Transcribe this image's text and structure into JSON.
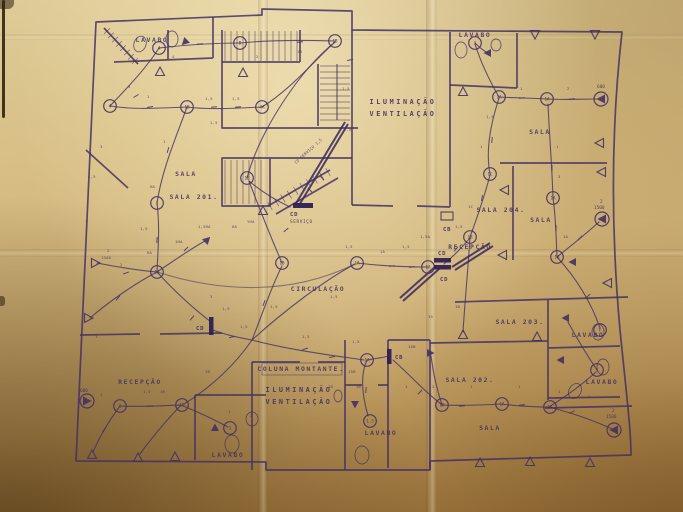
{
  "photo": {
    "paper_color": "#cfb278",
    "ink_color": "#453064",
    "ink_bold": "#2e2052"
  },
  "titles": {
    "shaft_top": {
      "lines": [
        "ILUMINAÇÃO",
        "VENTILAÇÃO"
      ],
      "x": 403,
      "y": 104
    },
    "shaft_bottom": {
      "lines": [
        "ILUMINAÇÃO",
        "VENTILAÇÃO"
      ],
      "x": 299,
      "y": 392
    }
  },
  "rooms": [
    {
      "label": "LAVABO",
      "x": 152,
      "y": 42
    },
    {
      "label": "LAVABO",
      "x": 475,
      "y": 37
    },
    {
      "label": "SALA",
      "x": 540,
      "y": 134
    },
    {
      "label": "SALA",
      "x": 186,
      "y": 176
    },
    {
      "label": "SALA 201.",
      "x": 194,
      "y": 199
    },
    {
      "label": "SALA 204.",
      "x": 501,
      "y": 212
    },
    {
      "label": "RECEPÇÃO",
      "x": 470,
      "y": 249
    },
    {
      "label": "SALA",
      "x": 541,
      "y": 222
    },
    {
      "label": "CIRCULAÇÃO",
      "x": 318,
      "y": 291
    },
    {
      "label": "SALA 203.",
      "x": 520,
      "y": 324
    },
    {
      "label": "LAVABO",
      "x": 588,
      "y": 337
    },
    {
      "label": "LAVABO",
      "x": 602,
      "y": 384
    },
    {
      "label": "SALA 202.",
      "x": 470,
      "y": 382
    },
    {
      "label": "RECEPÇÃO",
      "x": 140,
      "y": 384
    },
    {
      "label": "COLUNA MONTANTE.",
      "x": 301,
      "y": 371
    },
    {
      "label": "LAVABO",
      "x": 381,
      "y": 435
    },
    {
      "label": "LAVABO",
      "x": 228,
      "y": 457
    },
    {
      "label": "SALA",
      "x": 490,
      "y": 430
    }
  ],
  "panels": [
    {
      "label": "CD",
      "sub": "SERVIÇO",
      "bar": [
        293,
        203,
        20,
        5
      ],
      "lx": 290,
      "ly": 216,
      "sx": 290,
      "sy": 223
    },
    {
      "label": "CD",
      "sub": "",
      "bar": [
        434,
        258,
        17,
        4.5
      ],
      "lx": 438,
      "ly": 255,
      "sx": 0,
      "sy": 0
    },
    {
      "label": "CD",
      "sub": "",
      "bar": [
        434,
        265,
        17,
        4.5
      ],
      "lx": 440,
      "ly": 281,
      "sx": 0,
      "sy": 0
    },
    {
      "label": "CD",
      "sub": "",
      "bar": [
        209,
        317,
        4.5,
        18
      ],
      "lx": 196,
      "ly": 330,
      "sx": 0,
      "sy": 0
    },
    {
      "label": "CB",
      "sub": "",
      "bar": [
        387,
        349,
        4.5,
        15
      ],
      "lx": 395,
      "ly": 359,
      "sx": 0,
      "sy": 0
    },
    {
      "label": "CB",
      "sub": "",
      "box": [
        441,
        212,
        12,
        8
      ],
      "lx": 443,
      "ly": 231,
      "sx": 0,
      "sy": 0
    }
  ],
  "lights": [
    {
      "x": 159,
      "y": 48,
      "t": "4"
    },
    {
      "x": 240,
      "y": 43,
      "t": "B"
    },
    {
      "x": 335,
      "y": 41,
      "t": "1B"
    },
    {
      "x": 110,
      "y": 106,
      "t": "4"
    },
    {
      "x": 187,
      "y": 107,
      "t": "1B"
    },
    {
      "x": 262,
      "y": 107,
      "t": "4A"
    },
    {
      "x": 247,
      "y": 178,
      "t": "1B"
    },
    {
      "x": 157,
      "y": 203,
      "t": "1"
    },
    {
      "x": 157,
      "y": 272,
      "t": "1A"
    },
    {
      "x": 282,
      "y": 263,
      "t": "1B"
    },
    {
      "x": 357,
      "y": 263,
      "t": "1A"
    },
    {
      "x": 428,
      "y": 267,
      "t": "1A"
    },
    {
      "x": 470,
      "y": 237,
      "t": "1B"
    },
    {
      "x": 490,
      "y": 174,
      "t": "1C"
    },
    {
      "x": 499,
      "y": 97,
      "t": "1A"
    },
    {
      "x": 547,
      "y": 99,
      "t": "1A"
    },
    {
      "x": 475,
      "y": 43,
      "t": "1"
    },
    {
      "x": 553,
      "y": 198,
      "t": "1A"
    },
    {
      "x": 557,
      "y": 257,
      "t": "1A"
    },
    {
      "x": 367,
      "y": 360,
      "t": "1A"
    },
    {
      "x": 370,
      "y": 421,
      "t": "1,5"
    },
    {
      "x": 120,
      "y": 406,
      "t": "1"
    },
    {
      "x": 182,
      "y": 405,
      "t": "1B"
    },
    {
      "x": 230,
      "y": 428,
      "t": "1"
    },
    {
      "x": 442,
      "y": 405,
      "t": "1B"
    },
    {
      "x": 502,
      "y": 404,
      "t": "1A"
    },
    {
      "x": 550,
      "y": 407,
      "t": "1A"
    },
    {
      "x": 597,
      "y": 370,
      "t": "1"
    },
    {
      "x": 600,
      "y": 330,
      "t": "F"
    }
  ],
  "fans": [
    {
      "x": 601,
      "y": 99,
      "r": 180,
      "label": "600",
      "lx": 597,
      "ly": 88
    },
    {
      "x": 602,
      "y": 219,
      "r": 180,
      "label": "2",
      "lx": 600,
      "ly": 203,
      "label2": "1500",
      "l2x": 594,
      "l2y": 209
    },
    {
      "x": 614,
      "y": 430,
      "r": 180,
      "label": "2",
      "lx": 612,
      "ly": 412,
      "label2": "1500",
      "l2x": 606,
      "l2y": 418
    },
    {
      "x": 87,
      "y": 401,
      "r": 0,
      "label": "600",
      "lx": 80,
      "ly": 392
    }
  ],
  "vents": [
    {
      "x": 160,
      "y": 72,
      "r": 0
    },
    {
      "x": 243,
      "y": 73,
      "r": 0
    },
    {
      "x": 263,
      "y": 211,
      "r": 0
    },
    {
      "x": 535,
      "y": 34,
      "r": 180
    },
    {
      "x": 595,
      "y": 34,
      "r": 180
    },
    {
      "x": 463,
      "y": 92,
      "r": 0
    },
    {
      "x": 95,
      "y": 263,
      "r": 90
    },
    {
      "x": 88,
      "y": 318,
      "r": 90
    },
    {
      "x": 92,
      "y": 455,
      "r": 0
    },
    {
      "x": 138,
      "y": 458,
      "r": 0
    },
    {
      "x": 175,
      "y": 457,
      "r": 0
    },
    {
      "x": 463,
      "y": 335,
      "r": 0
    },
    {
      "x": 537,
      "y": 337,
      "r": 0
    },
    {
      "x": 480,
      "y": 463,
      "r": 0
    },
    {
      "x": 530,
      "y": 462,
      "r": 0
    },
    {
      "x": 590,
      "y": 463,
      "r": 0
    },
    {
      "x": 608,
      "y": 283,
      "r": 270
    },
    {
      "x": 602,
      "y": 172,
      "r": 270
    },
    {
      "x": 505,
      "y": 190,
      "r": 270
    },
    {
      "x": 503,
      "y": 255,
      "r": 270
    },
    {
      "x": 600,
      "y": 143,
      "r": 270
    }
  ],
  "filled_triangles": [
    {
      "x": 185,
      "y": 42,
      "r": 225
    },
    {
      "x": 207,
      "y": 240,
      "r": 45
    },
    {
      "x": 355,
      "y": 404,
      "r": 180
    },
    {
      "x": 573,
      "y": 262,
      "r": 270
    },
    {
      "x": 215,
      "y": 428,
      "r": 0
    },
    {
      "x": 566,
      "y": 318,
      "r": 270
    },
    {
      "x": 561,
      "y": 360,
      "r": 270
    },
    {
      "x": 488,
      "y": 53,
      "r": 270
    },
    {
      "x": 430,
      "y": 353,
      "r": 90
    }
  ],
  "fixtures": [
    {
      "x": 140,
      "y": 44,
      "rx": 6,
      "ry": 8,
      "r": 20
    },
    {
      "x": 172,
      "y": 39,
      "rx": 6,
      "ry": 8,
      "r": 0
    },
    {
      "x": 461,
      "y": 50,
      "rx": 6,
      "ry": 8,
      "r": 0
    },
    {
      "x": 496,
      "y": 45,
      "rx": 5,
      "ry": 6,
      "r": 0
    },
    {
      "x": 598,
      "y": 332,
      "rx": 6,
      "ry": 8,
      "r": 0
    },
    {
      "x": 603,
      "y": 367,
      "rx": 6,
      "ry": 8,
      "r": 0
    },
    {
      "x": 575,
      "y": 391,
      "rx": 6,
      "ry": 8,
      "r": 30
    },
    {
      "x": 362,
      "y": 455,
      "rx": 7,
      "ry": 9,
      "r": 0
    },
    {
      "x": 338,
      "y": 396,
      "rx": 4,
      "ry": 6,
      "r": 0
    },
    {
      "x": 232,
      "y": 444,
      "rx": 7,
      "ry": 9,
      "r": 0
    },
    {
      "x": 252,
      "y": 419,
      "rx": 6,
      "ry": 7,
      "r": 0
    }
  ],
  "ticks": [
    {
      "x": 136,
      "y": 96,
      "a": 60
    },
    {
      "x": 150,
      "y": 107,
      "a": 80
    },
    {
      "x": 214,
      "y": 107,
      "a": 85
    },
    {
      "x": 238,
      "y": 107,
      "a": 85
    },
    {
      "x": 168,
      "y": 150,
      "a": 15
    },
    {
      "x": 157,
      "y": 240,
      "a": 5
    },
    {
      "x": 126,
      "y": 273,
      "a": 70
    },
    {
      "x": 118,
      "y": 298,
      "a": 40
    },
    {
      "x": 186,
      "y": 249,
      "a": 45
    },
    {
      "x": 192,
      "y": 318,
      "a": 40
    },
    {
      "x": 232,
      "y": 337,
      "a": 75
    },
    {
      "x": 264,
      "y": 303,
      "a": 20
    },
    {
      "x": 305,
      "y": 349,
      "a": 70
    },
    {
      "x": 332,
      "y": 357,
      "a": 80
    },
    {
      "x": 392,
      "y": 266,
      "a": 85
    },
    {
      "x": 412,
      "y": 267,
      "a": 85
    },
    {
      "x": 456,
      "y": 249,
      "a": 40
    },
    {
      "x": 482,
      "y": 198,
      "a": 10
    },
    {
      "x": 492,
      "y": 140,
      "a": 5
    },
    {
      "x": 522,
      "y": 98,
      "a": 85
    },
    {
      "x": 572,
      "y": 99,
      "a": 85
    },
    {
      "x": 552,
      "y": 168,
      "a": 0
    },
    {
      "x": 556,
      "y": 228,
      "a": 0
    },
    {
      "x": 580,
      "y": 238,
      "a": 45
    },
    {
      "x": 588,
      "y": 296,
      "a": 50
    },
    {
      "x": 462,
      "y": 406,
      "a": 85
    },
    {
      "x": 522,
      "y": 405,
      "a": 85
    },
    {
      "x": 572,
      "y": 412,
      "a": 65
    },
    {
      "x": 150,
      "y": 406,
      "a": 85
    },
    {
      "x": 104,
      "y": 430,
      "a": 40
    },
    {
      "x": 366,
      "y": 390,
      "a": 5
    },
    {
      "x": 420,
      "y": 392,
      "a": 45
    },
    {
      "x": 350,
      "y": 60,
      "a": 80
    },
    {
      "x": 300,
      "y": 42,
      "a": 85
    },
    {
      "x": 200,
      "y": 44,
      "a": 85
    },
    {
      "x": 286,
      "y": 230,
      "a": 50
    },
    {
      "x": 310,
      "y": 190,
      "a": -42
    },
    {
      "x": 322,
      "y": 178,
      "a": -42
    }
  ],
  "annotations": [
    {
      "x": 128,
      "y": 88,
      "t": "4"
    },
    {
      "x": 147,
      "y": 98,
      "t": "1"
    },
    {
      "x": 205,
      "y": 100,
      "t": "1,5"
    },
    {
      "x": 232,
      "y": 100,
      "t": "1,5"
    },
    {
      "x": 256,
      "y": 58,
      "t": "2"
    },
    {
      "x": 172,
      "y": 58,
      "t": "4"
    },
    {
      "x": 210,
      "y": 124,
      "t": "1,5"
    },
    {
      "x": 297,
      "y": 53,
      "t": "1B"
    },
    {
      "x": 342,
      "y": 90,
      "t": "1,5"
    },
    {
      "x": 344,
      "y": 131,
      "t": "T.A"
    },
    {
      "x": 163,
      "y": 143,
      "t": "1"
    },
    {
      "x": 150,
      "y": 188,
      "t": "HA"
    },
    {
      "x": 140,
      "y": 230,
      "t": "1,5"
    },
    {
      "x": 147,
      "y": 254,
      "t": "HA"
    },
    {
      "x": 120,
      "y": 266,
      "t": "2"
    },
    {
      "x": 175,
      "y": 243,
      "t": "1HA"
    },
    {
      "x": 198,
      "y": 228,
      "t": "1,5HA"
    },
    {
      "x": 232,
      "y": 228,
      "t": "HA"
    },
    {
      "x": 247,
      "y": 223,
      "t": "YHA"
    },
    {
      "x": 210,
      "y": 298,
      "t": "3"
    },
    {
      "x": 222,
      "y": 310,
      "t": "1,5"
    },
    {
      "x": 240,
      "y": 328,
      "t": "1,5"
    },
    {
      "x": 270,
      "y": 308,
      "t": "1,5"
    },
    {
      "x": 302,
      "y": 338,
      "t": "1,5"
    },
    {
      "x": 330,
      "y": 298,
      "t": "1,5"
    },
    {
      "x": 345,
      "y": 248,
      "t": "1,5"
    },
    {
      "x": 380,
      "y": 253,
      "t": "1A"
    },
    {
      "x": 402,
      "y": 248,
      "t": "1,5"
    },
    {
      "x": 420,
      "y": 238,
      "t": "1,5A"
    },
    {
      "x": 455,
      "y": 228,
      "t": "1,5"
    },
    {
      "x": 468,
      "y": 208,
      "t": "1C"
    },
    {
      "x": 480,
      "y": 148,
      "t": "1"
    },
    {
      "x": 486,
      "y": 118,
      "t": "1,5"
    },
    {
      "x": 520,
      "y": 90,
      "t": "1"
    },
    {
      "x": 567,
      "y": 90,
      "t": "2"
    },
    {
      "x": 556,
      "y": 148,
      "t": "1"
    },
    {
      "x": 558,
      "y": 178,
      "t": "3"
    },
    {
      "x": 563,
      "y": 238,
      "t": "1A"
    },
    {
      "x": 455,
      "y": 308,
      "t": "1B"
    },
    {
      "x": 428,
      "y": 318,
      "t": "15"
    },
    {
      "x": 408,
      "y": 348,
      "t": "10B"
    },
    {
      "x": 352,
      "y": 343,
      "t": "1,5"
    },
    {
      "x": 348,
      "y": 373,
      "t": "15B"
    },
    {
      "x": 356,
      "y": 388,
      "t": "1B"
    },
    {
      "x": 328,
      "y": 388,
      "t": "1B"
    },
    {
      "x": 405,
      "y": 388,
      "t": "1"
    },
    {
      "x": 432,
      "y": 388,
      "t": "2"
    },
    {
      "x": 470,
      "y": 388,
      "t": "1"
    },
    {
      "x": 518,
      "y": 388,
      "t": "1"
    },
    {
      "x": 558,
      "y": 393,
      "t": "1"
    },
    {
      "x": 588,
      "y": 398,
      "t": "1"
    },
    {
      "x": 100,
      "y": 396,
      "t": "1"
    },
    {
      "x": 143,
      "y": 393,
      "t": "1,5"
    },
    {
      "x": 160,
      "y": 393,
      "t": "1B"
    },
    {
      "x": 228,
      "y": 413,
      "t": "1"
    },
    {
      "x": 250,
      "y": 417,
      "t": "2"
    },
    {
      "x": 205,
      "y": 373,
      "t": "1B"
    },
    {
      "x": 95,
      "y": 338,
      "t": "1"
    },
    {
      "x": 85,
      "y": 223,
      "t": "1"
    },
    {
      "x": 88,
      "y": 178,
      "t": "1,5"
    },
    {
      "x": 100,
      "y": 148,
      "t": "3"
    },
    {
      "x": 107,
      "y": 252,
      "t": "2"
    },
    {
      "x": 101,
      "y": 259,
      "t": "1500"
    },
    {
      "x": 296,
      "y": 164,
      "t": "CD SERVIÇO 1,5",
      "r": -42
    }
  ]
}
